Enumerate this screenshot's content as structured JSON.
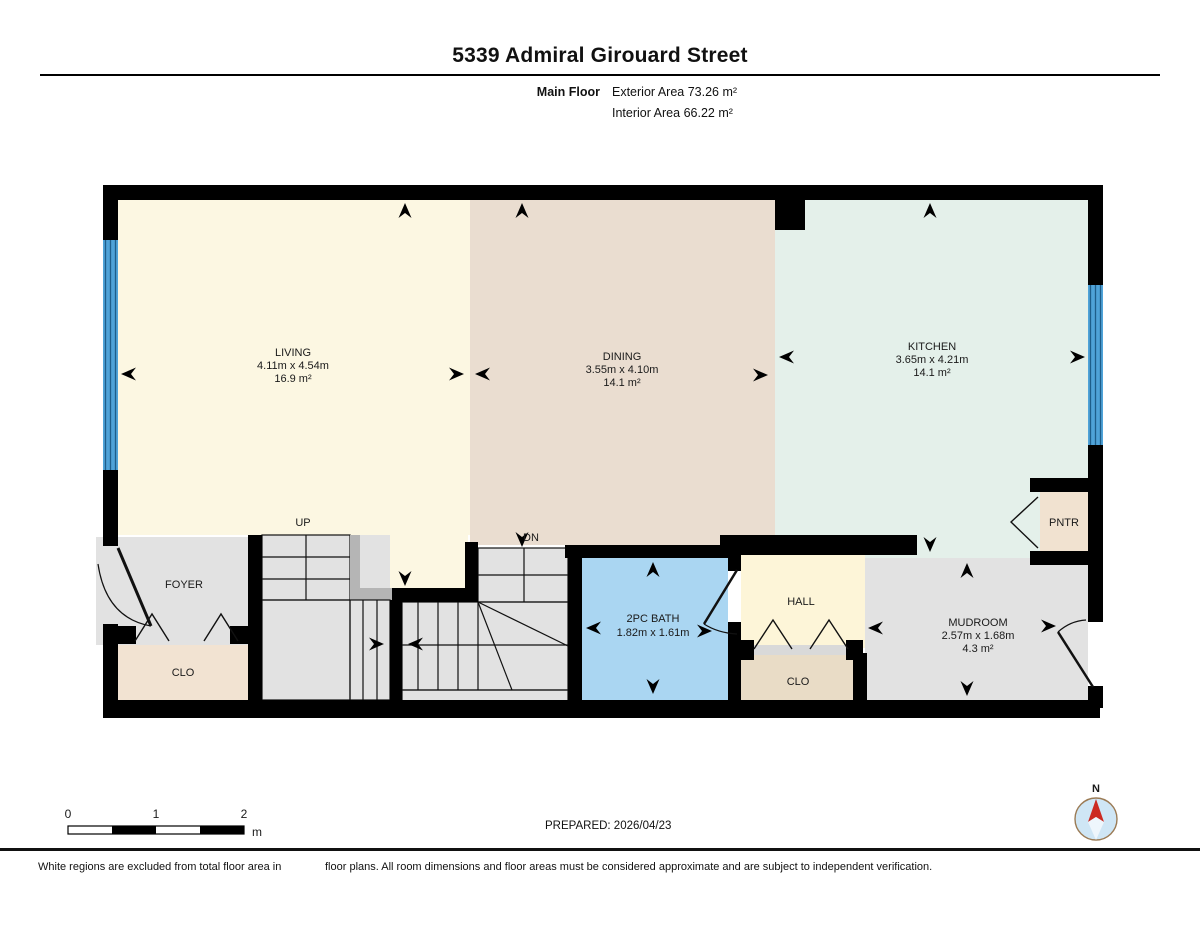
{
  "header": {
    "title": "5339 Admiral Girouard Street",
    "floor_label": "Main Floor",
    "exterior_area": "Exterior Area 73.26 m²",
    "interior_area": "Interior Area 66.22 m²"
  },
  "rooms": {
    "living": {
      "name": "LIVING",
      "dims": "4.11m x 4.54m",
      "area": "16.9 m²"
    },
    "dining": {
      "name": "DINING",
      "dims": "3.55m x 4.10m",
      "area": "14.1 m²"
    },
    "kitchen": {
      "name": "KITCHEN",
      "dims": "3.65m x 4.21m",
      "area": "14.1 m²"
    },
    "foyer": {
      "name": "FOYER"
    },
    "foyer_closet": {
      "name": "CLO"
    },
    "bath": {
      "name": "2PC BATH",
      "dims": "1.82m x 1.61m"
    },
    "hall": {
      "name": "HALL"
    },
    "hall_closet": {
      "name": "CLO"
    },
    "mudroom": {
      "name": "MUDROOM",
      "dims": "2.57m x 1.68m",
      "area": "4.3 m²"
    },
    "pantry": {
      "name": "PNTR"
    }
  },
  "stairs": {
    "up": "UP",
    "down": "DN"
  },
  "scale_bar": {
    "ticks": [
      "0",
      "1",
      "2"
    ],
    "unit": "m"
  },
  "prepared": "PREPARED: 2026/04/23",
  "compass": {
    "north": "N"
  },
  "footer": {
    "left": "White regions are excluded from total floor area in",
    "right": "floor plans. All room dimensions and floor areas must be considered approximate and are subject to independent verification."
  },
  "colors": {
    "wall": "#000000",
    "living": "#fcf7e2",
    "dining": "#eaddd0",
    "kitchen": "#e4f0ea",
    "circulation_gray": "#e2e2e2",
    "bath": "#aad6f2",
    "hall": "#fdf5d8",
    "closet_foyer": "#f2e3d2",
    "closet_hall": "#e9dcc6",
    "pantry": "#f1e2d0",
    "window": "#4fa3d8",
    "compass_north": "#cc2a22"
  }
}
